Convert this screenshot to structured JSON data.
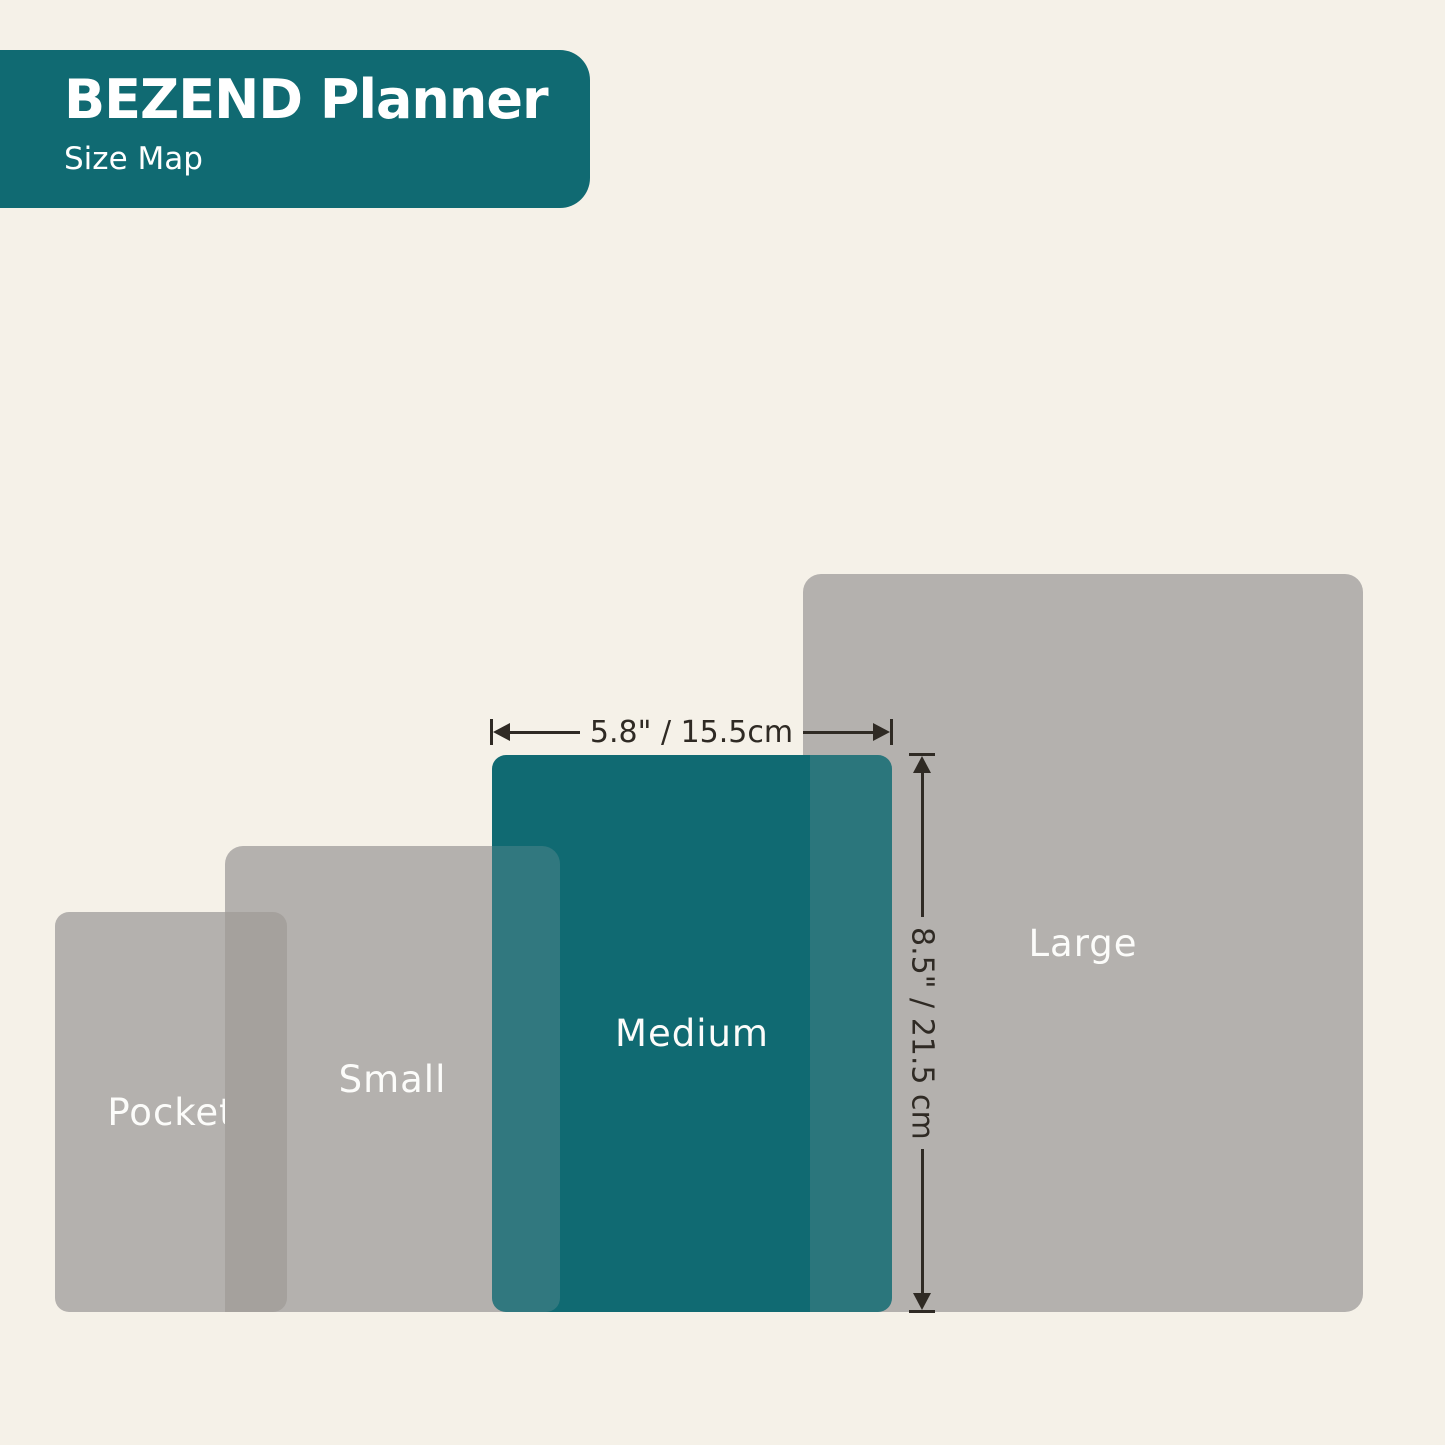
{
  "header": {
    "title": "BEZEND Planner",
    "subtitle": "Size Map"
  },
  "sizes": [
    {
      "id": "pocket",
      "label": "Pocket"
    },
    {
      "id": "small",
      "label": "Small"
    },
    {
      "id": "medium",
      "label": "Medium",
      "width": "5.8\" / 15.5cm",
      "height": "8.5\" / 21.5 cm",
      "highlighted": true
    },
    {
      "id": "large",
      "label": "Large"
    }
  ],
  "dimensions": {
    "width_label": "5.8\" / 15.5cm",
    "height_label": "8.5\" / 21.5 cm"
  },
  "colors": {
    "teal": "#106a72",
    "gray": "#b4b1ae",
    "gray-overlap": "#a5a19d",
    "cream": "#f5f1e8",
    "line": "#2f2a24",
    "label": "#fcfcfa"
  }
}
